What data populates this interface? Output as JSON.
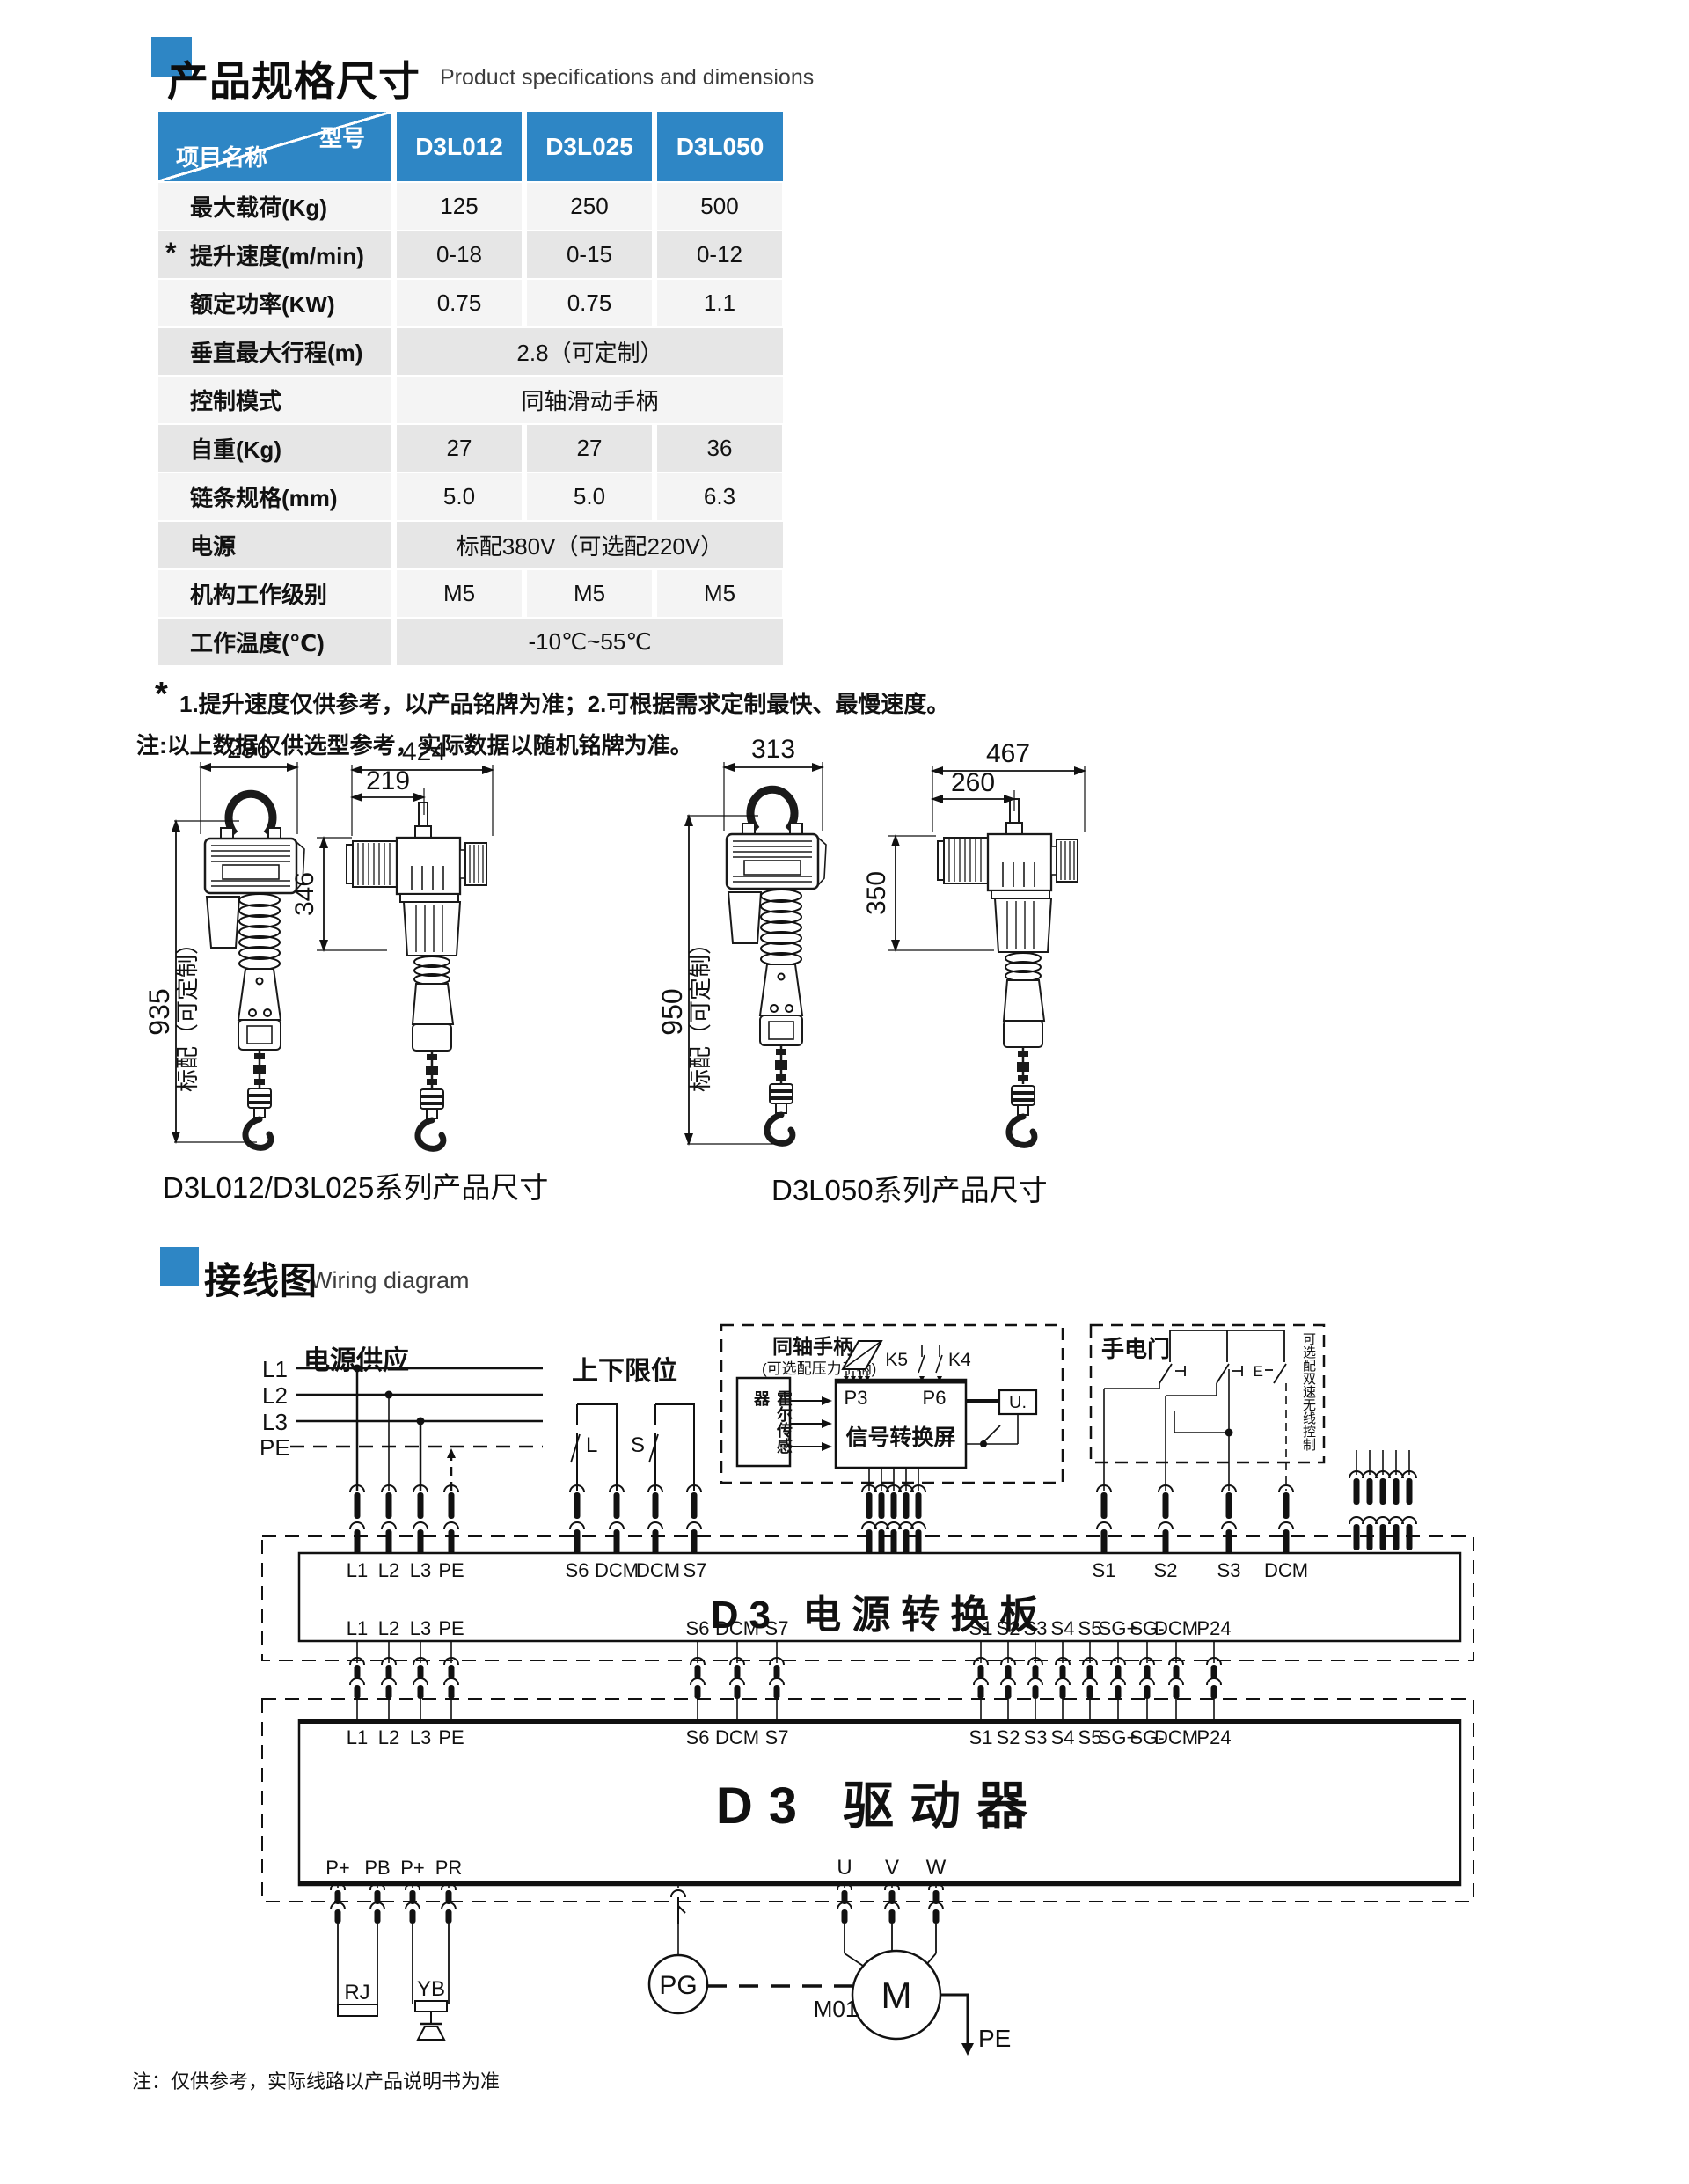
{
  "colors": {
    "accent": "#2E86C5"
  },
  "spec": {
    "title": "产品规格尺寸",
    "subtitle": "Product specifications and dimensions",
    "table": {
      "corner_top": "型号",
      "corner_bottom": "项目名称",
      "models": [
        "D3L012",
        "D3L025",
        "D3L050"
      ],
      "rows": [
        {
          "label": "最大载荷(Kg)",
          "values": [
            "125",
            "250",
            "500"
          ]
        },
        {
          "star": "*",
          "label": "提升速度(m/min)",
          "values": [
            "0-18",
            "0-15",
            "0-12"
          ]
        },
        {
          "label": "额定功率(KW)",
          "values": [
            "0.75",
            "0.75",
            "1.1"
          ]
        },
        {
          "label": "垂直最大行程(m)",
          "span": "2.8（可定制）"
        },
        {
          "label": "控制模式",
          "span": "同轴滑动手柄"
        },
        {
          "label": "自重(Kg)",
          "values": [
            "27",
            "27",
            "36"
          ]
        },
        {
          "label": "链条规格(mm)",
          "values": [
            "5.0",
            "5.0",
            "6.3"
          ]
        },
        {
          "label": "电源",
          "span": "标配380V（可选配220V）"
        },
        {
          "label": "机构工作级别",
          "values": [
            "M5",
            "M5",
            "M5"
          ]
        },
        {
          "label": "工作温度(℃)",
          "span": "-10℃~55℃"
        }
      ],
      "note_star_mark": "*",
      "note_star": "1.提升速度仅供参考，以产品铭牌为准；2.可根据需求定制最快、最慢速度。",
      "note": "注:以上数据仅供选型参考，实际数据以随机铭牌为准。"
    },
    "drawings": {
      "group1": {
        "caption": "D3L012/D3L025系列产品尺寸",
        "width_front": "296",
        "width_side": "424",
        "width_side_inner": "219",
        "height_side": "346",
        "height_total": "935",
        "height_note": "标配（可定制）"
      },
      "group2": {
        "caption": "D3L050系列产品尺寸",
        "width_front": "313",
        "width_side": "467",
        "width_side_inner": "260",
        "height_side": "350",
        "height_total": "950",
        "height_note": "标配（可定制）"
      }
    }
  },
  "wiring": {
    "title": "接线图",
    "subtitle": "Wiring diagram",
    "power": {
      "title": "电源供应",
      "l1": "L1",
      "l2": "L2",
      "l3": "L3",
      "pe": "PE"
    },
    "limit": {
      "title": "上下限位",
      "sw1": "L",
      "sw2": "S"
    },
    "handle_box": {
      "line1": "同轴手柄",
      "line2": "(可选配压力手柄)",
      "sensor": "霍尔传感器",
      "screen": "信号转换屏",
      "p3": "P3",
      "p6": "P6",
      "k5": "K5",
      "k4": "K4",
      "u": "U."
    },
    "pendant": {
      "title": "手电门",
      "e": "E",
      "side_note": "可选配双速无线控制"
    },
    "board": {
      "title": "D3 电源转换板",
      "top_left": [
        "L1",
        "L2",
        "L3",
        "PE"
      ],
      "top_mid": [
        "S6",
        "DCM",
        "DCM",
        "S7"
      ],
      "top_right": [
        "S1",
        "S2",
        "S3",
        "DCM"
      ],
      "bottom_left": [
        "L1",
        "L2",
        "L3",
        "PE"
      ],
      "bottom_mid": [
        "S6",
        "DCM",
        "S7"
      ],
      "bottom_right": [
        "S1",
        "S2",
        "S3",
        "S4",
        "S5",
        "SG+",
        "SG-",
        "DCM",
        "P24"
      ]
    },
    "driver": {
      "title": "D3 驱动器",
      "top_left": [
        "L1",
        "L2",
        "L3",
        "PE"
      ],
      "top_mid": [
        "S6",
        "DCM",
        "S7"
      ],
      "top_right": [
        "S1",
        "S2",
        "S3",
        "S4",
        "S5",
        "SG+",
        "SG-",
        "DCM",
        "P24"
      ],
      "bottom_left": [
        "P+",
        "PB",
        "P+",
        "PR"
      ],
      "bottom_right": [
        "U",
        "V",
        "W"
      ]
    },
    "components": {
      "rj": "RJ",
      "yb": "YB",
      "pg": "PG",
      "motor": "M",
      "motor_id": "M01",
      "pe": "PE"
    },
    "note": "注：仅供参考，实际线路以产品说明书为准"
  }
}
